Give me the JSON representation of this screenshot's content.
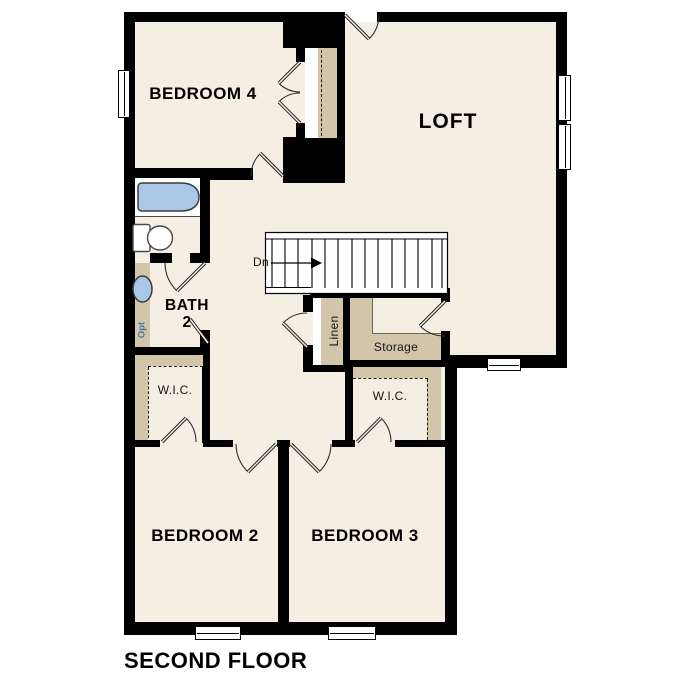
{
  "title": "SECOND FLOOR",
  "rooms": {
    "bedroom4": "BEDROOM 4",
    "loft": "LOFT",
    "bath_line1": "BATH",
    "bath_line2": "2",
    "bedroom2": "BEDROOM 2",
    "bedroom3": "BEDROOM 3",
    "wic_left": "W.I.C.",
    "wic_right": "W.I.C.",
    "storage": "Storage",
    "linen": "Linen"
  },
  "stairs": {
    "direction_label": "Dn"
  },
  "fixtures": {
    "vanity_note": "Opt"
  },
  "colors": {
    "background": "#ffffff",
    "floor": "#f5eee2",
    "shelf": "#d2c5a9",
    "wall": "#000000",
    "fixture_blue": "#a9c7e6",
    "note_blue": "#4a74ae"
  }
}
